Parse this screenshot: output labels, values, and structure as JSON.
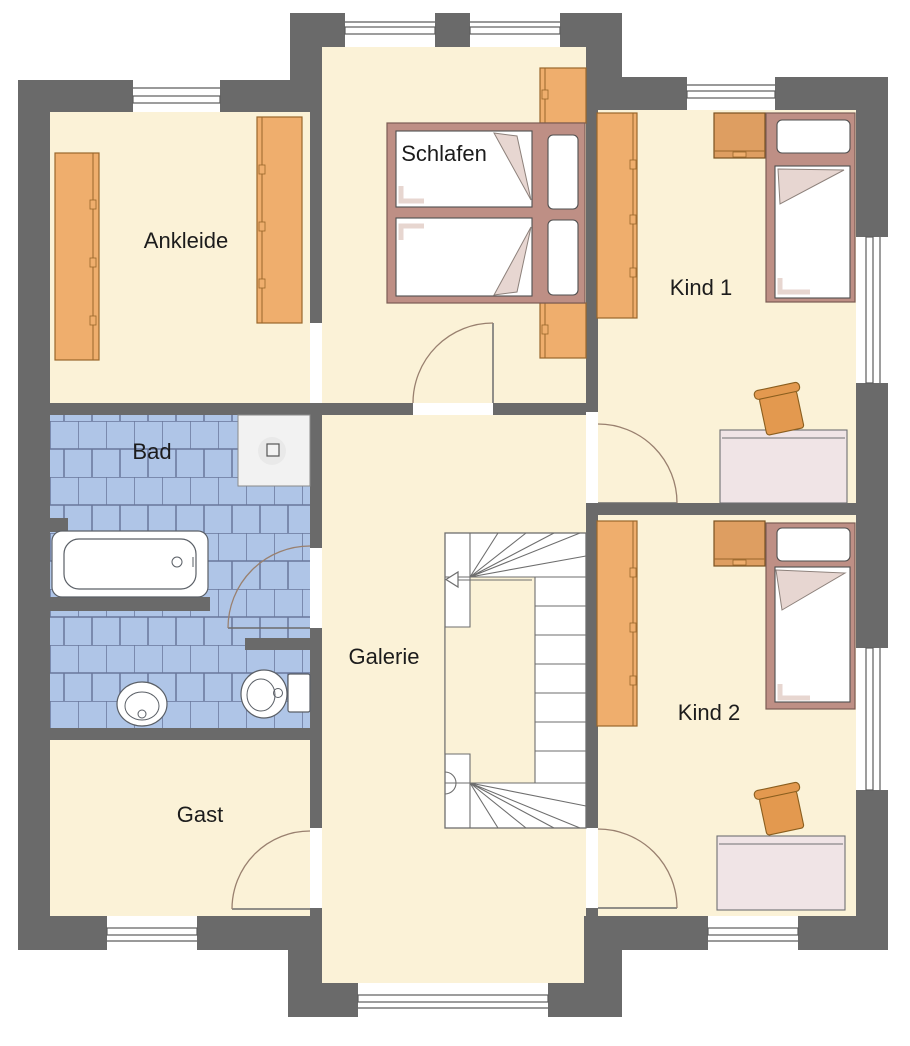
{
  "rooms": [
    {
      "id": "schlafen",
      "label": "Schlafen"
    },
    {
      "id": "ankleide",
      "label": "Ankleide"
    },
    {
      "id": "kind1",
      "label": "Kind 1"
    },
    {
      "id": "bad",
      "label": "Bad"
    },
    {
      "id": "galerie",
      "label": "Galerie"
    },
    {
      "id": "kind2",
      "label": "Kind 2"
    },
    {
      "id": "gast",
      "label": "Gast"
    }
  ],
  "colors": {
    "wall": "#6A6A6A",
    "floor": "#FBF2D7",
    "tile": "#AFC5E7",
    "tile_line": "#69779C",
    "wood": "#EFAE6D",
    "wood_edge": "#9A672B",
    "wood_dark": "#DE9E61",
    "bed_frame": "#BE8F85",
    "bed_frame_edge": "#7B5C54",
    "textile": "#E7D6D1",
    "desk": "#F0E4E6",
    "chair": "#E3994F",
    "stair": "#6E6E6E",
    "door_arc": "#99806F",
    "label": "#1C1C1C"
  }
}
